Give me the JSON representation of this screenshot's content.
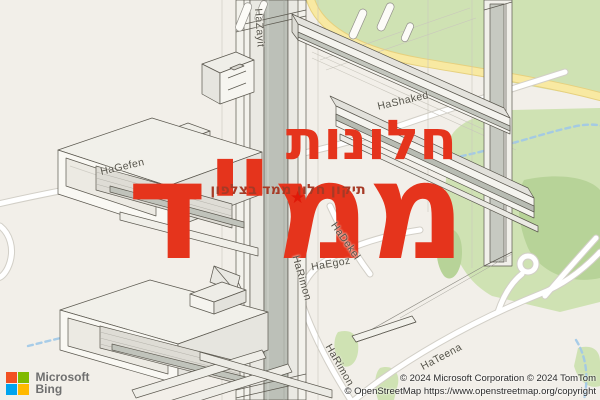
{
  "overlay": {
    "title_line1": "חלונות",
    "title_line2": "ממ\"ד",
    "subtitle": "תיקון חלון ממד בצלפון",
    "star_glyph": "★",
    "accent_color": "#e5341c",
    "subtitle_color": "#a63a26"
  },
  "map": {
    "street_labels": [
      {
        "id": "hazayit",
        "text": "HaZayit"
      },
      {
        "id": "hashaked",
        "text": "HaShaked"
      },
      {
        "id": "hagefen",
        "text": "HaGefen"
      },
      {
        "id": "hadekel",
        "text": "HaDekel"
      },
      {
        "id": "haegoz",
        "text": "HaEgoz"
      },
      {
        "id": "harimon1",
        "text": "HaRimon"
      },
      {
        "id": "harimon2",
        "text": "HaRimon"
      },
      {
        "id": "hateena",
        "text": "HaTeena"
      }
    ],
    "colors": {
      "land": "#f2efe9",
      "greenery": "#cfe2b3",
      "greenery_dark": "#b7d398",
      "road_fill": "#ffffff",
      "road_casing": "#d2cfc7",
      "road_yellow": "#f8e9a2",
      "stream_blue": "#9ec8e8"
    }
  },
  "branding": {
    "provider_line1": "Microsoft",
    "provider_line2": "Bing"
  },
  "attribution": {
    "line1": "© 2024 Microsoft Corporation © 2024 TomTom",
    "line2": "© OpenStreetMap https://www.openstreetmap.org/copyright"
  }
}
